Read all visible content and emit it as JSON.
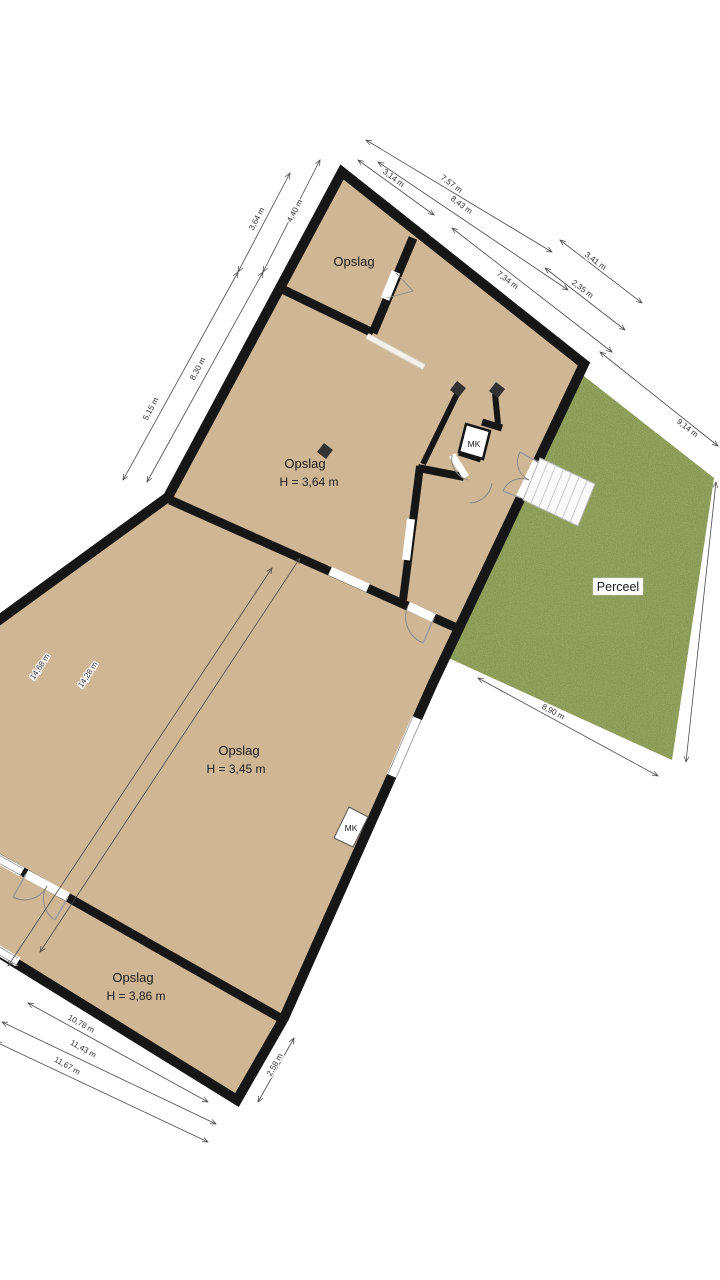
{
  "plan_type": "floorplan",
  "colors": {
    "floor": "#cfb695",
    "wall": "#161616",
    "grass": "#7e9046",
    "grass_dark_speckle": "#5f7030",
    "grass_light_speckle": "#a8b468",
    "dimension_line": "#4a4a4a"
  },
  "rooms": {
    "top": {
      "label": "Opslag"
    },
    "middle": {
      "label": "Opslag",
      "height": "H = 3,64 m"
    },
    "long": {
      "label": "Opslag",
      "height": "H = 3,45 m"
    },
    "bottom": {
      "label": "Opslag",
      "height": "H = 3,86 m"
    }
  },
  "parcel": {
    "label": "Perceel"
  },
  "meter_closets": {
    "entry": "MK",
    "wall": "MK"
  },
  "dimensions": {
    "left_wall_upper": "4,40 m",
    "left_wall_lower": "8,30 m",
    "left_outer_upper": "3,64 m",
    "left_outer_lower": "5,15 m",
    "west_total_outer": "14,68 m",
    "west_total_inner": "14,28 m",
    "top_inner_1": "3,14 m",
    "top_inner_2": "7,34 m",
    "top_mid_1": "8,43 m",
    "top_mid_2": "2,35 m",
    "top_outer_1": "7,57 m",
    "top_outer_2": "3,41 m",
    "parcel_ne": "9,14 m",
    "parcel_s": "8,90 m",
    "bottom_end": "2,58 m",
    "bottom_sw_1": "10,78 m",
    "bottom_sw_2": "11,43 m",
    "bottom_sw_3": "11,67 m"
  }
}
